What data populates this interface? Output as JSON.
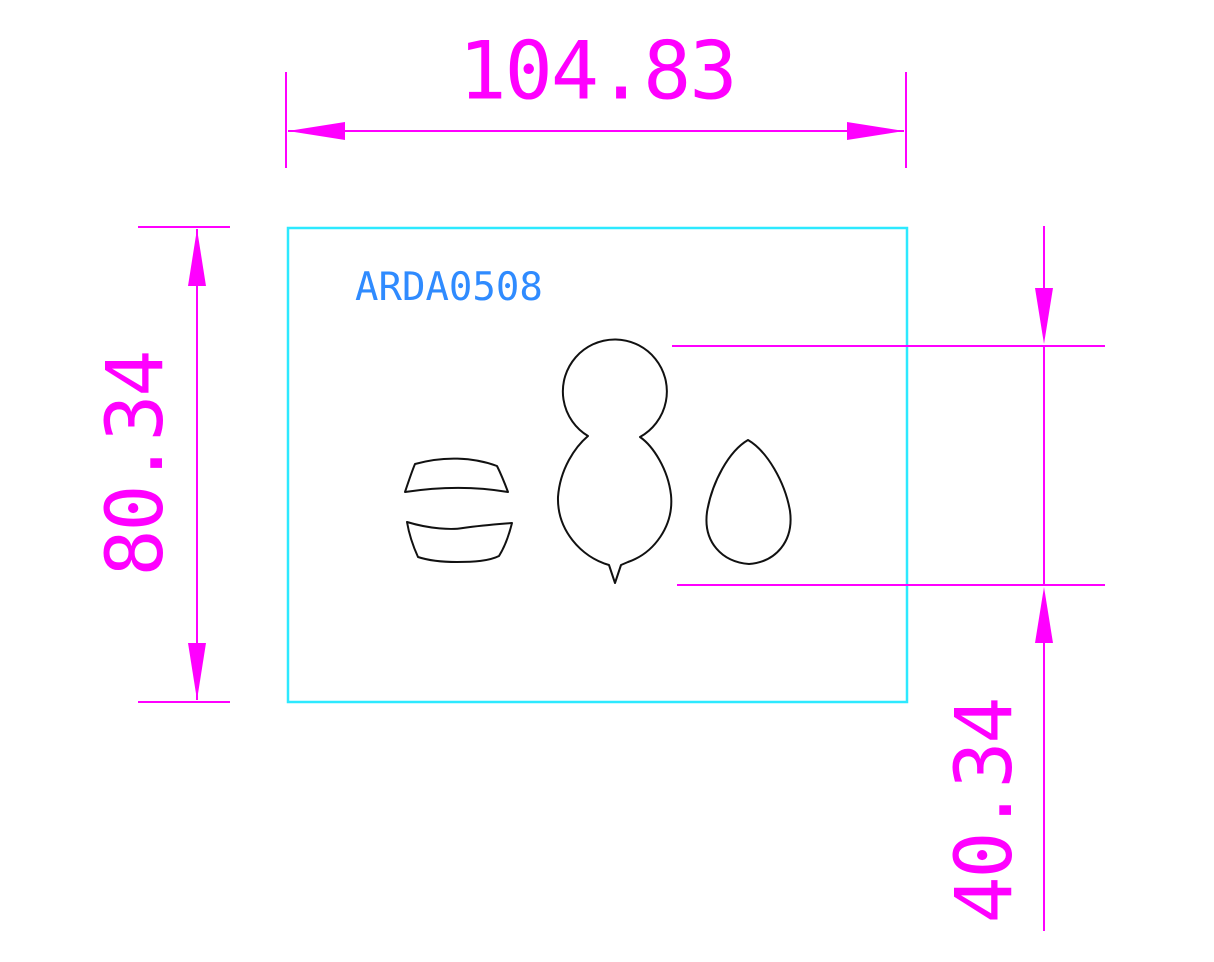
{
  "drawing": {
    "part_label": "ARDA0508",
    "dimensions": {
      "width": {
        "value": "104.83"
      },
      "height": {
        "value": "80.34"
      },
      "feature_height": {
        "value": "40.34"
      }
    },
    "colors": {
      "dimension_magenta": "#FF00FF",
      "boundary_cyan": "#2DE9FF",
      "label_blue": "#2F8BFF",
      "geometry_black": "#111111",
      "background": "#FFFFFF"
    },
    "shapes": [
      "barrel-top-blank",
      "barrel-bottom-blank",
      "snowman-blank",
      "egg-blank"
    ]
  }
}
